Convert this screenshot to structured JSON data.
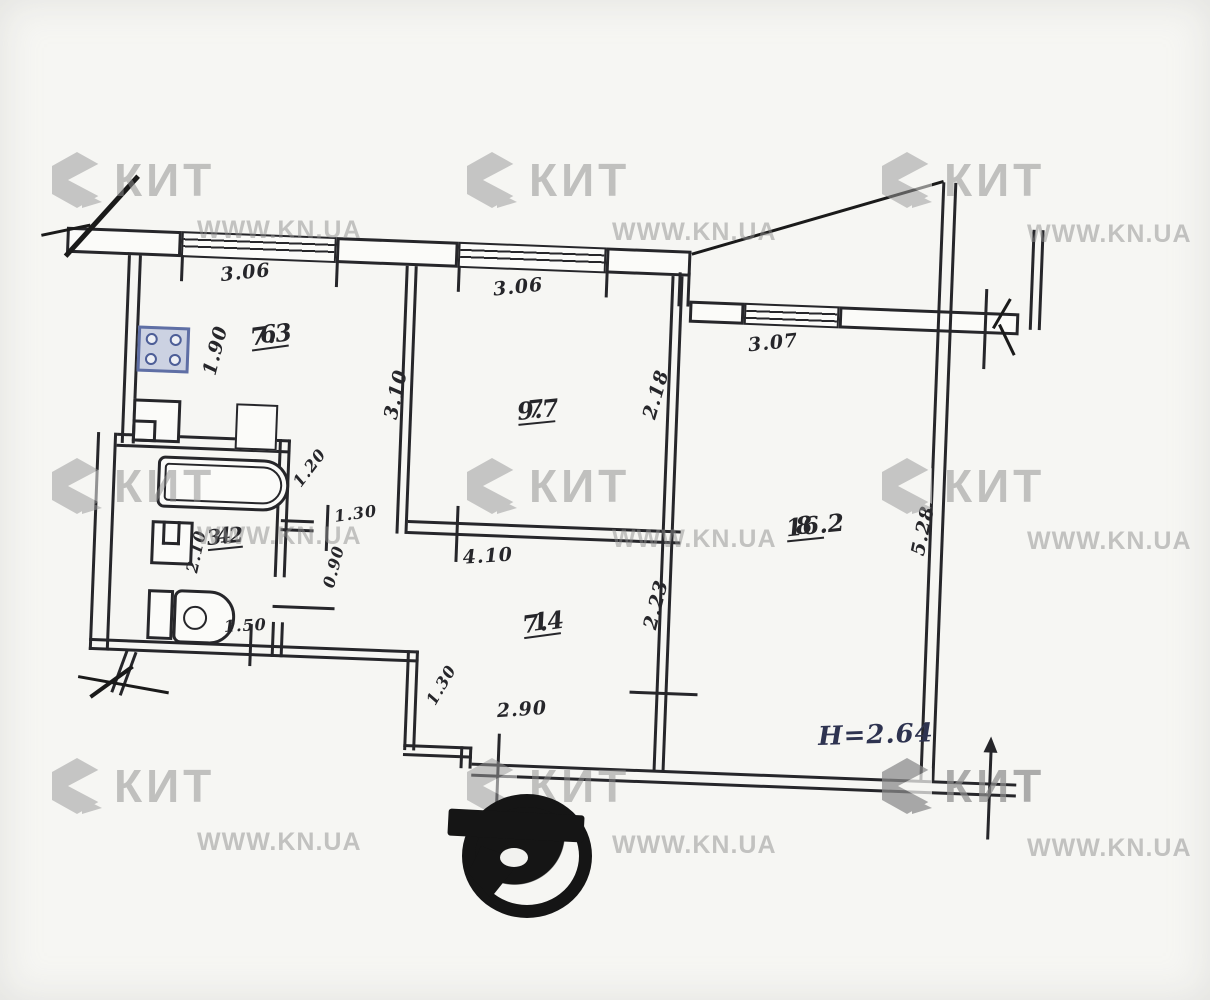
{
  "watermark": {
    "brand": "КИТ",
    "site": "WWW.KN.UA"
  },
  "plan": {
    "rooms": [
      {
        "number": "6",
        "area": "7.3"
      },
      {
        "number": "7",
        "area": "9.7"
      },
      {
        "number": "8",
        "area": "16.2"
      },
      {
        "number": "1",
        "area": "7.4"
      },
      {
        "number": "4",
        "area": "3.2"
      }
    ],
    "dimensions": {
      "window_left": "3.06",
      "window_mid": "3.06",
      "window_right": "3.07",
      "kitchen_depth": "1.90",
      "kitchen_wall": "3.10",
      "room7_side": "2.18",
      "room8_side": "5.28",
      "niche": "1.20",
      "bath_side": "2.10",
      "bath_width": "1.50",
      "hall_niche": "0.90",
      "door_width": "1.30",
      "hall_top": "4.10",
      "hall_left": "1.30",
      "hall_right": "2.23",
      "hall_bottom": "2.90"
    },
    "ceiling_height": "H=2.64"
  }
}
